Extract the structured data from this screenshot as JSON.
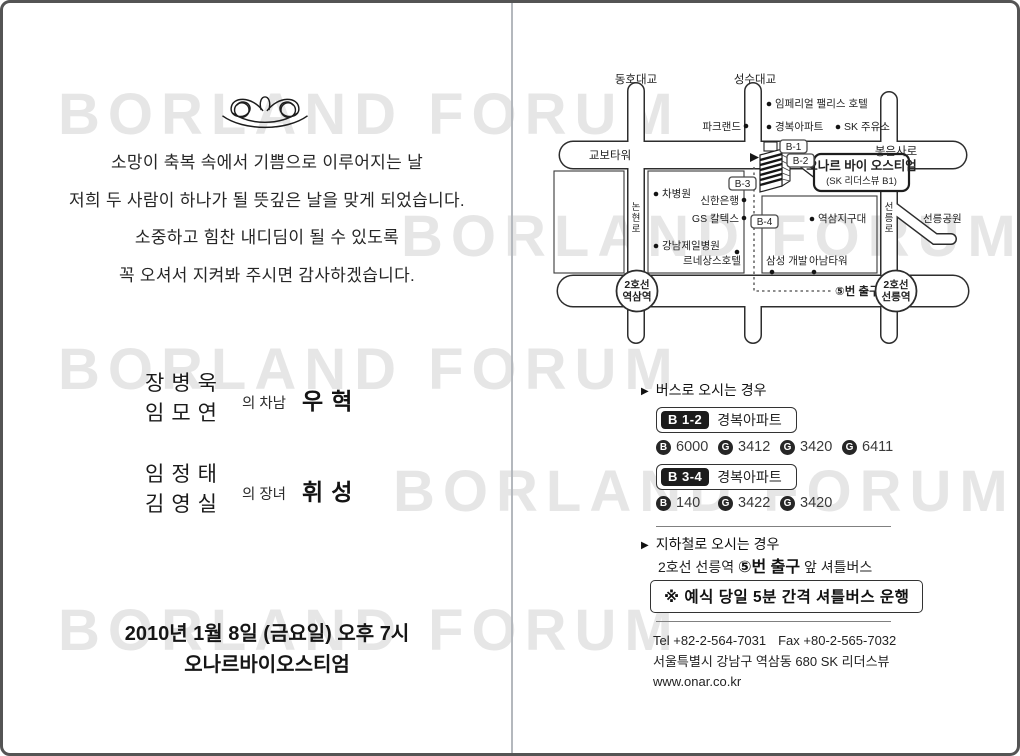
{
  "watermark": {
    "text": "BORLAND FORUM"
  },
  "left": {
    "invite_lines": [
      "소망이 축복 속에서 기쁨으로 이루어지는 날",
      "저희 두 사람이 하나가 될 뜻깊은 날을 맞게 되었습니다.",
      "소중하고 힘찬 내디딤이 될 수 있도록",
      "꼭 오셔서 지켜봐 주시면 감사하겠습니다."
    ],
    "groom": {
      "father": "장병욱",
      "mother": "임모연",
      "relation": "의 차남",
      "name": "우혁"
    },
    "bride": {
      "father": "임정태",
      "mother": "김영실",
      "relation": "의 장녀",
      "name": "휘성"
    },
    "datetime": "2010년 1월 8일 (금요일) 오후 7시",
    "venue": "오나르바이오스티엄"
  },
  "map": {
    "labels": {
      "dongho": "동호대교",
      "seongsu": "성수대교",
      "kyobo": "교보타워",
      "bongeunsa": "봉은사로",
      "nonhyeon": "논현로",
      "seolleung_ro": "선릉로",
      "parkland": "파크랜드",
      "imperial": "임페리얼 팰리스 호텔",
      "gyeongbok_apt": "경복아파트",
      "sk_gas": "SK 주유소",
      "cha_hospital": "차병원",
      "shinhan": "신한은행",
      "gs_caltex": "GS 칼텍스",
      "kangnam_jeil": "강남제일병원",
      "renaissance": "르네상스호텔",
      "yeoksam_police": "역삼지구대",
      "samsung_dev": "삼성 개발",
      "anam_tower": "아남타워",
      "seolleung_park": "선릉공원",
      "b1": "B-1",
      "b2": "B-2",
      "b3": "B-3",
      "b4": "B-4",
      "venue": "오나르 바이 오스티엄",
      "venue_sub": "(SK 리더스뷰 B1)",
      "exit5": "⑤번 출구",
      "yeoksam_line": "2호선",
      "yeoksam_st": "역삼역",
      "seolleung_line": "2호선",
      "seolleung_st": "선릉역"
    }
  },
  "bus": {
    "header": "버스로 오시는 경우",
    "stops": [
      {
        "badge": "B 1-2",
        "name": "경복아파트",
        "lines": [
          {
            "t": "B",
            "n": "6000"
          },
          {
            "t": "G",
            "n": "3412"
          },
          {
            "t": "G",
            "n": "3420"
          },
          {
            "t": "G",
            "n": "6411"
          }
        ]
      },
      {
        "badge": "B 3-4",
        "name": "경복아파트",
        "lines": [
          {
            "t": "B",
            "n": "140"
          },
          {
            "t": "G",
            "n": "3422"
          },
          {
            "t": "G",
            "n": "3420"
          }
        ]
      }
    ]
  },
  "subway": {
    "header": "지하철로 오시는 경우",
    "line_pre": "2호선 선릉역 ",
    "line_bold": "⑤번 출구",
    "line_post": " 앞 셔틀버스"
  },
  "notice": "※ 예식 당일 5분 간격 셔틀버스 운행",
  "contact": {
    "tel": "Tel +82-2-564-7031",
    "fax": "Fax +80-2-565-7032",
    "address": "서울특별시 강남구 역삼동 680 SK 리더스뷰",
    "website": "www.onar.co.kr"
  }
}
